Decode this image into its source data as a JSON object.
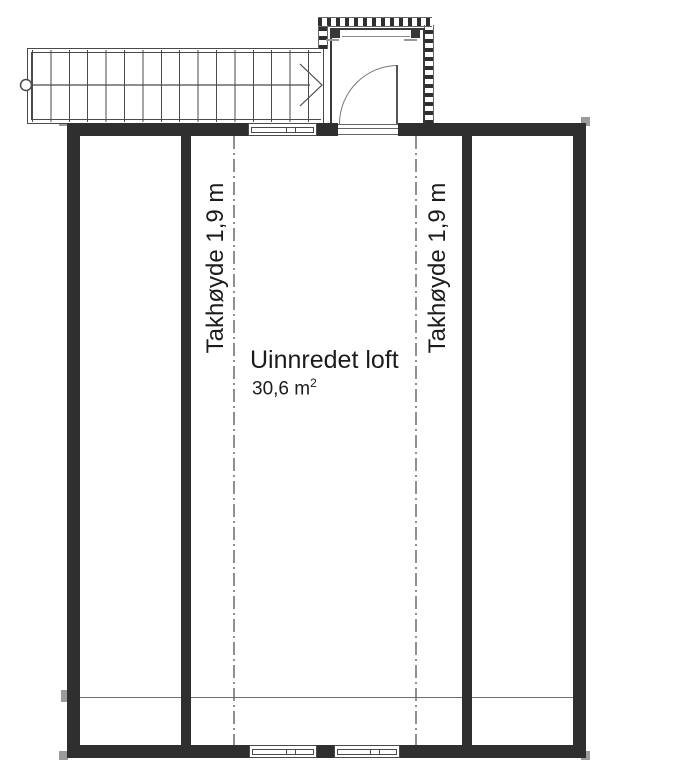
{
  "floorplan": {
    "room_label": "Uinnredet loft",
    "room_area_value": "30,6 m",
    "room_area_sup": "2",
    "ceiling_height_left": "Takhøyde 1,9 m",
    "ceiling_height_right": "Takhøyde 1,9 m"
  },
  "colors": {
    "wall": "#2f2f2f",
    "line": "#4a4a4a",
    "thin": "#6f6f6f",
    "dash": "#8f8f8f",
    "text": "#1c1c1c"
  }
}
